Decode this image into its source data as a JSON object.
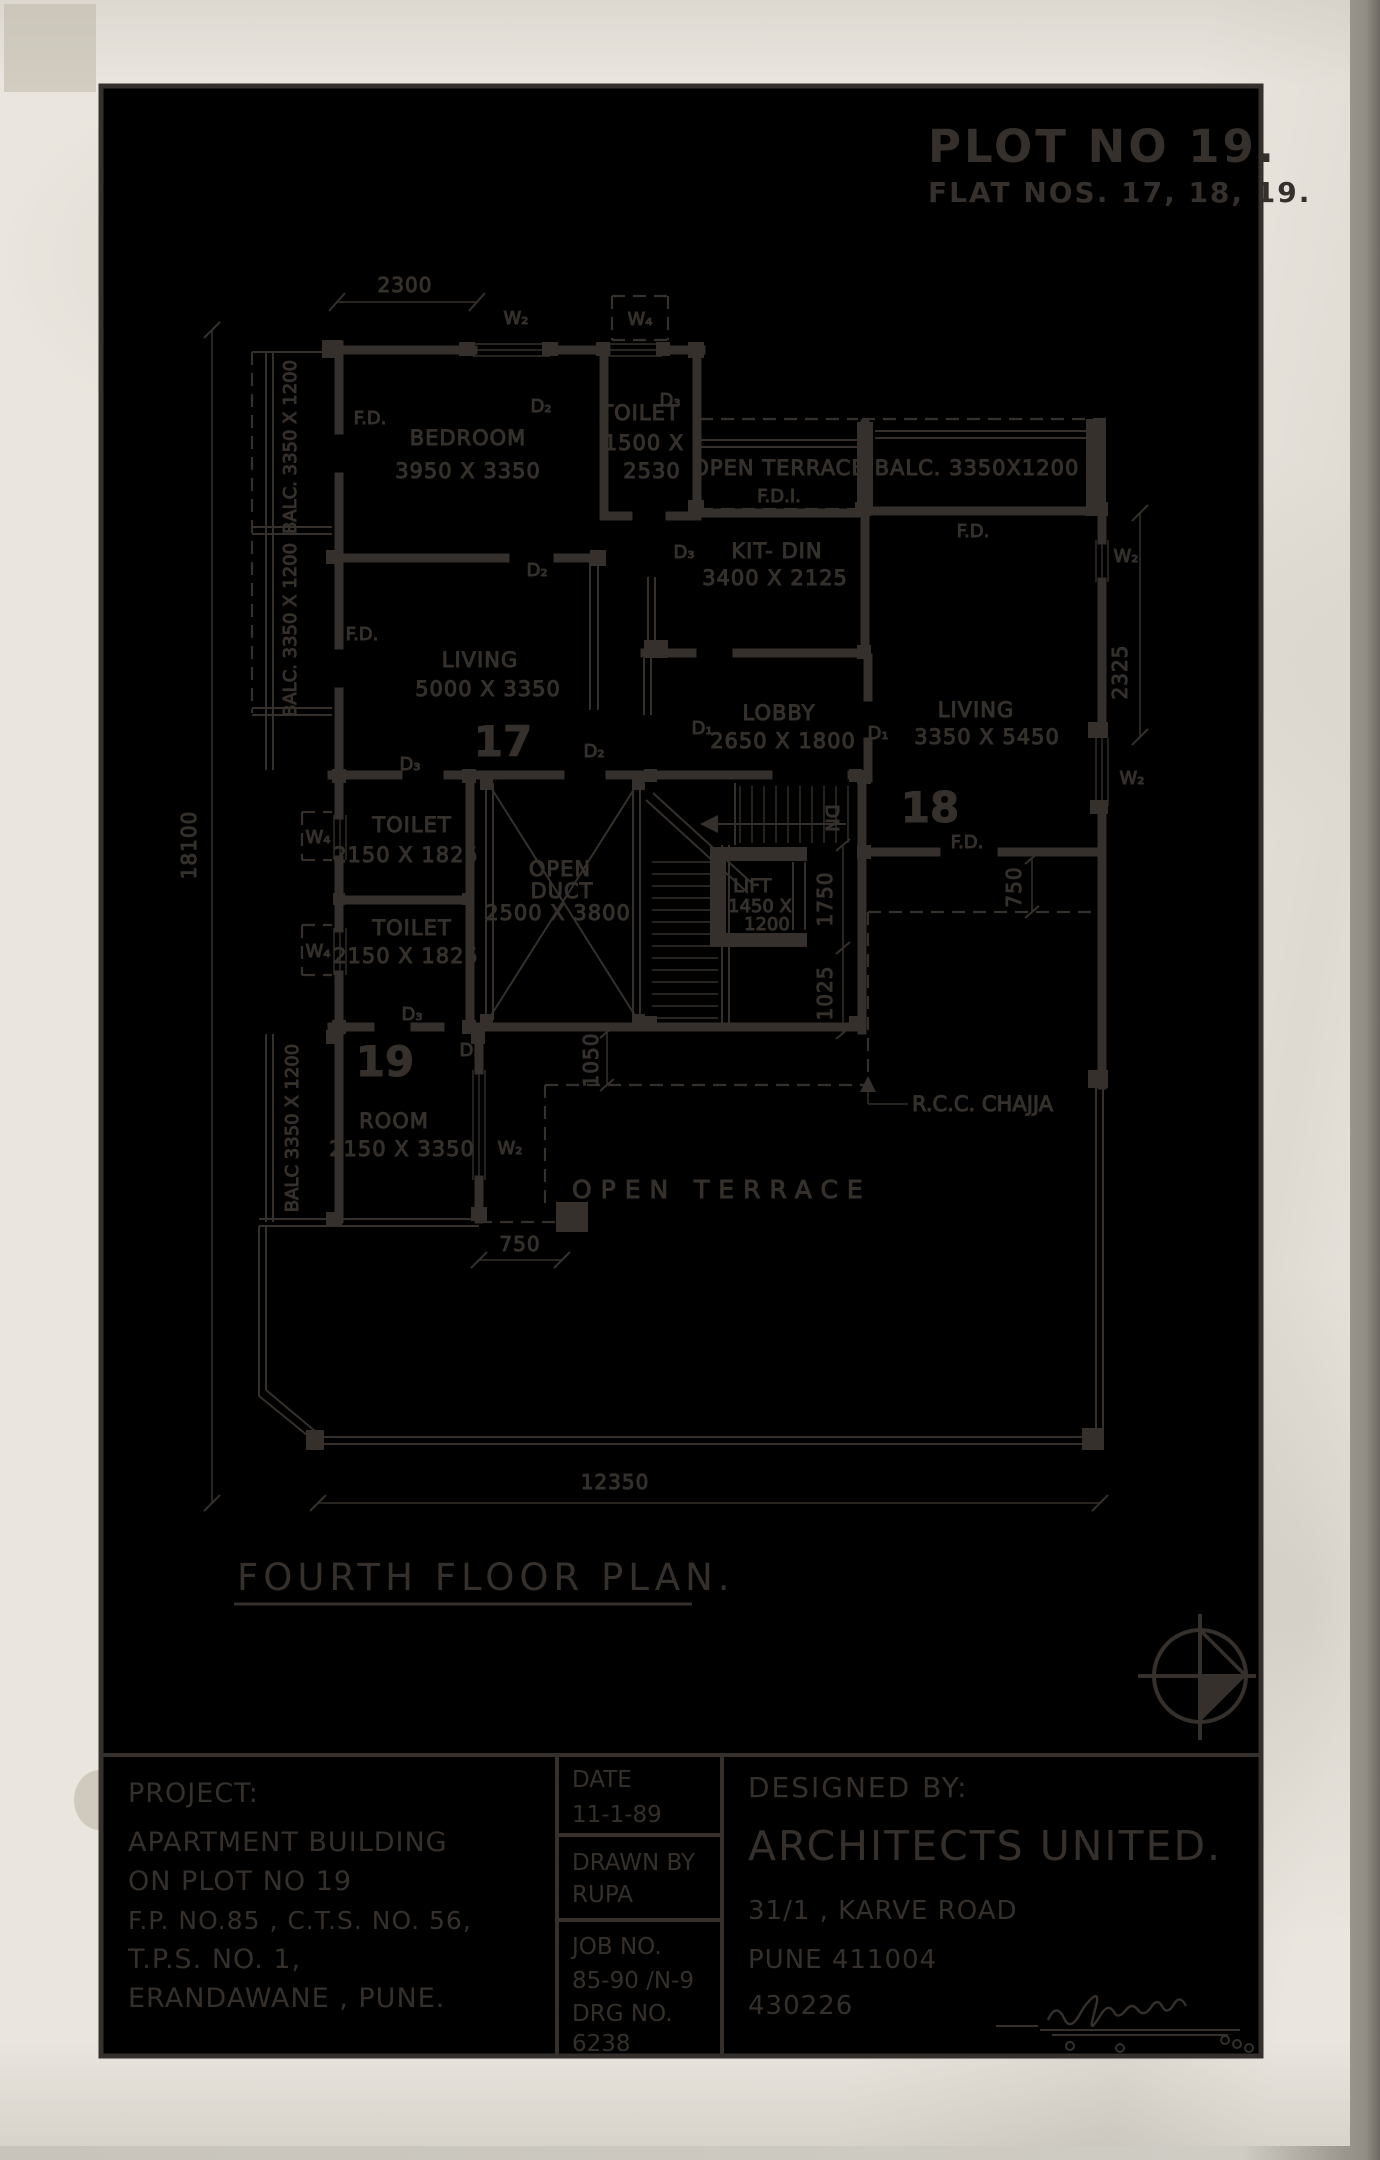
{
  "header": {
    "plot_no": "PLOT NO 19.",
    "flat_nos": "FLAT NOS. 17, 18, 19."
  },
  "flats": {
    "f17": "17",
    "f18": "18",
    "f19": "19"
  },
  "rooms": {
    "bedroom": {
      "name": "BEDROOM",
      "size": "3950 X 3350"
    },
    "toilet_top": {
      "name": "TOILET",
      "size_a": "1500 X",
      "size_b": "2530"
    },
    "terrace_top": {
      "name": "OPEN TERRACE"
    },
    "balc_top": {
      "name": "BALC. 3350X1200"
    },
    "kit_din": {
      "name": "KIT- DIN",
      "size": "3400 X 2125"
    },
    "living17": {
      "name": "LIVING",
      "size": "5000 X 3350"
    },
    "lobby": {
      "name": "LOBBY",
      "size": "2650 X 1800"
    },
    "living18": {
      "name": "LIVING",
      "size": "3350 X 5450"
    },
    "toilet_a": {
      "name": "TOILET",
      "size": "2150 X 1825"
    },
    "toilet_b": {
      "name": "TOILET",
      "size": "2150 X 1825"
    },
    "duct": {
      "name_a": "OPEN",
      "name_b": "DUCT",
      "size": "2500 X 3800"
    },
    "lift": {
      "name": "LIFT",
      "size_a": "1450 X",
      "size_b": "1200"
    },
    "room19": {
      "name": "ROOM",
      "size": "2150 X 3350"
    },
    "terrace_bottom": {
      "word_a": "OPEN",
      "word_b": "TERRACE"
    },
    "balc_left_a": "BALC. 3350 X 1200",
    "balc_left_b": "BALC. 3350 X 1200",
    "balc_19": "BALC 3350 X 1200"
  },
  "tags": {
    "w2": "W₂",
    "w4": "W₄",
    "d1": "D₁",
    "d2": "D₂",
    "d3": "D₃",
    "fd": "F.D.",
    "fdi": "F.D.I.",
    "dn": "DN",
    "rcc": "R.C.C. CHAJJA"
  },
  "dims": {
    "top": "2300",
    "left": "18100",
    "right": "2325",
    "bottom": "12350",
    "stair_a": "1750",
    "stair_b": "1025",
    "corridor": "750",
    "terrace_gap": "1050",
    "balc_gap": "750"
  },
  "plan_title": "FOURTH FLOOR PLAN.",
  "title_block": {
    "project_label": "PROJECT:",
    "line1": "APARTMENT BUILDING",
    "line2": "ON PLOT NO 19",
    "line3": "F.P. NO.85 , C.T.S. NO. 56,",
    "line4": "T.P.S. NO. 1,",
    "line5": "ERANDAWANE , PUNE.",
    "date_label": "DATE",
    "date_value": "11-1-89",
    "drawn_label": "DRAWN BY",
    "drawn_value": "RUPA",
    "job_label": "JOB NO.",
    "job_value": "85-90 /N-9",
    "drg_label": "DRG NO.",
    "drg_value": "6238",
    "designed_label": "DESIGNED BY:",
    "firm": "ARCHITECTS UNITED.",
    "address1": "31/1 , KARVE ROAD",
    "address2": "PUNE 411004",
    "phone": "430226"
  },
  "colors": {
    "ink": "#35302b",
    "paper": "#eae6df",
    "pencil": "#bfb5a3"
  }
}
